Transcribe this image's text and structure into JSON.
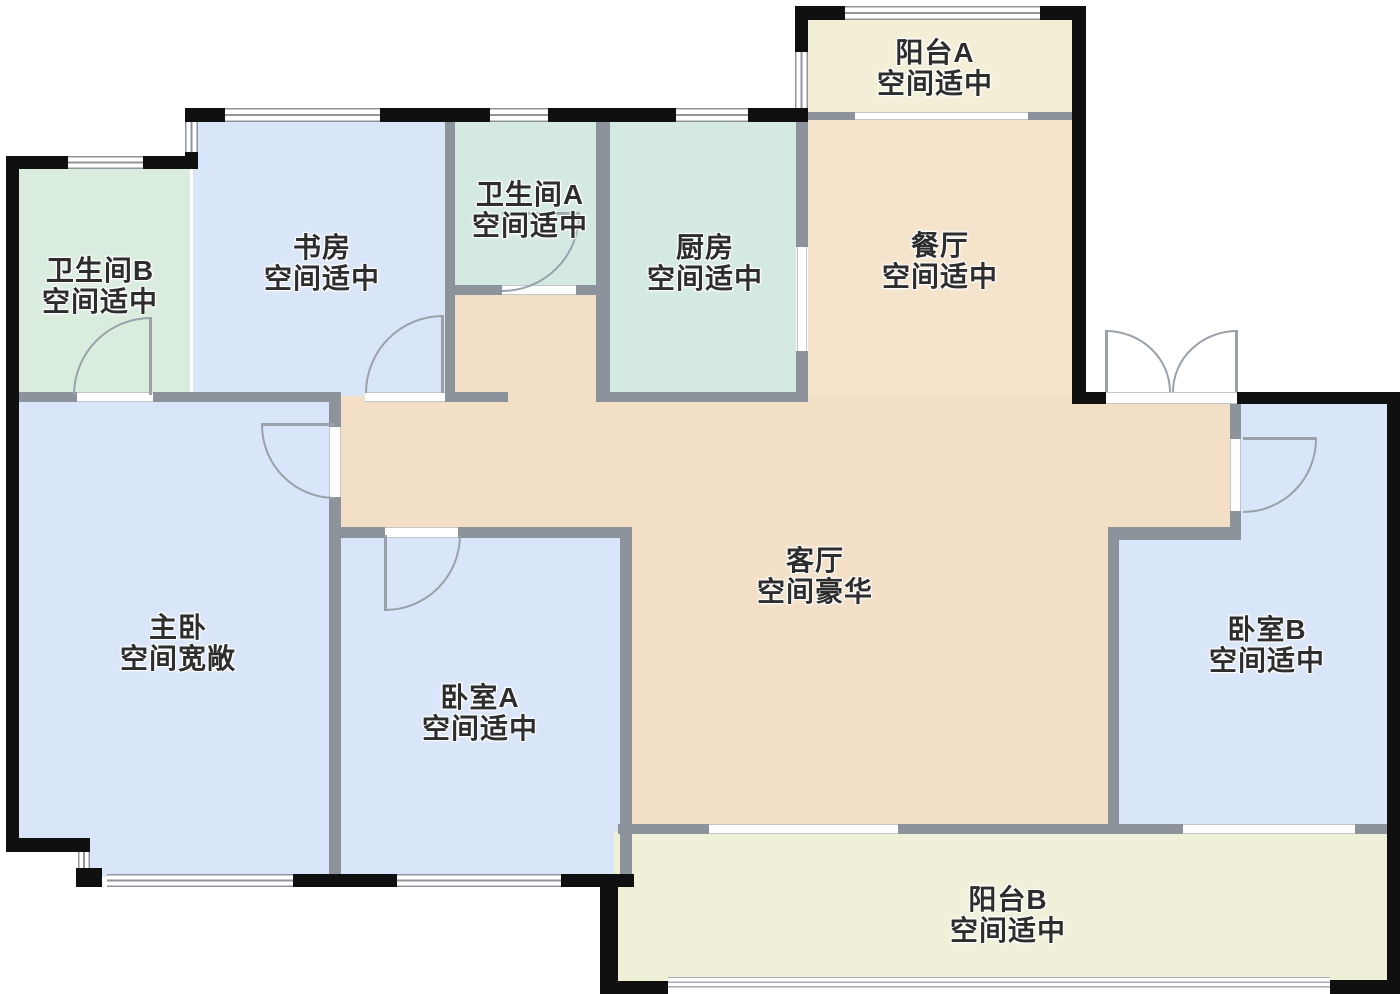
{
  "plan_title": "apartment-floor-plan",
  "palette": {
    "wall_outer": "#101010",
    "wall_inner": "#8d939b",
    "door_line": "#9aa1a9",
    "bedroom_fill": "#d9e5f8",
    "bath_b_fill": "#d9ecdd",
    "bath_a_kitchen_fill": "#d3e9e1",
    "dining_fill": "#f5e4cb",
    "living_fill": "#f2dfc6",
    "balcony_a_fill": "#f2efd6",
    "balcony_b_fill": "#f0efd8",
    "text": "#2d2d2d"
  },
  "rooms": {
    "balcony_a": {
      "name": "阳台A",
      "status": "空间适中"
    },
    "dining": {
      "name": "餐厅",
      "status": "空间适中"
    },
    "bath_b": {
      "name": "卫生间B",
      "status": "空间适中"
    },
    "study": {
      "name": "书房",
      "status": "空间适中"
    },
    "bath_a": {
      "name": "卫生间A",
      "status": "空间适中"
    },
    "kitchen": {
      "name": "厨房",
      "status": "空间适中"
    },
    "master": {
      "name": "主卧",
      "status": "空间宽敞"
    },
    "bed_a": {
      "name": "卧室A",
      "status": "空间适中"
    },
    "living": {
      "name": "客厅",
      "status": "空间豪华"
    },
    "bed_b": {
      "name": "卧室B",
      "status": "空间适中"
    },
    "balcony_b": {
      "name": "阳台B",
      "status": "空间适中"
    }
  }
}
